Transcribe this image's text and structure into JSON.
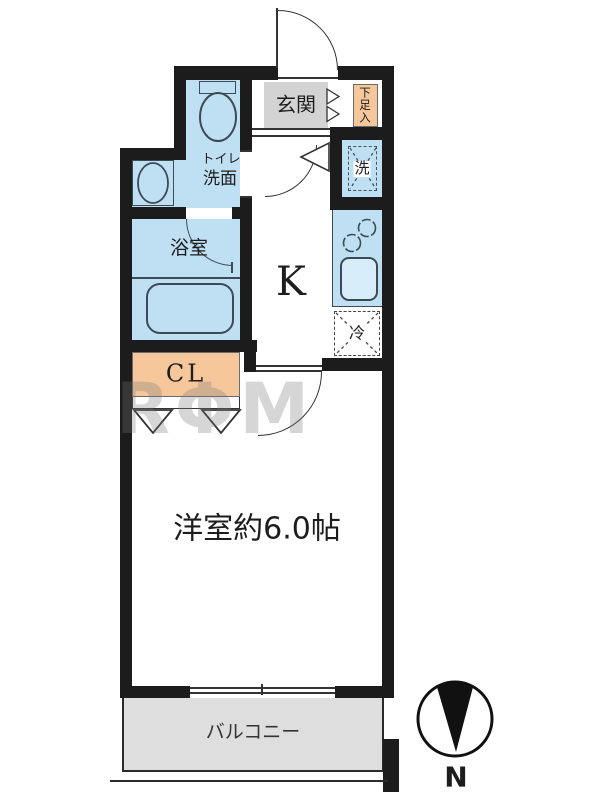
{
  "fp": {
    "watermark": "RΦM",
    "compass": {
      "north_label": "N"
    },
    "rooms": {
      "entrance": {
        "label": "玄関"
      },
      "shoe_storage": {
        "label": "下足入"
      },
      "washer_space": {
        "label": "洗"
      },
      "toilet_washroom": {
        "label_line1": "トイレ",
        "label_line2": "洗面"
      },
      "bathroom": {
        "label": "浴室"
      },
      "kitchen": {
        "label": "K"
      },
      "refrigerator_space": {
        "label": "冷"
      },
      "closet": {
        "label": "CL"
      },
      "western_room": {
        "label": "洋室約6.0帖"
      },
      "balcony": {
        "label": "バルコニー"
      }
    },
    "colors": {
      "wet_area_blue": "#bfe0f2",
      "entrance_gray": "#d3d3d3",
      "storage_orange": "#f6c79b",
      "balcony_gray": "#dedede",
      "wall_black": "#1c1c1c"
    }
  }
}
